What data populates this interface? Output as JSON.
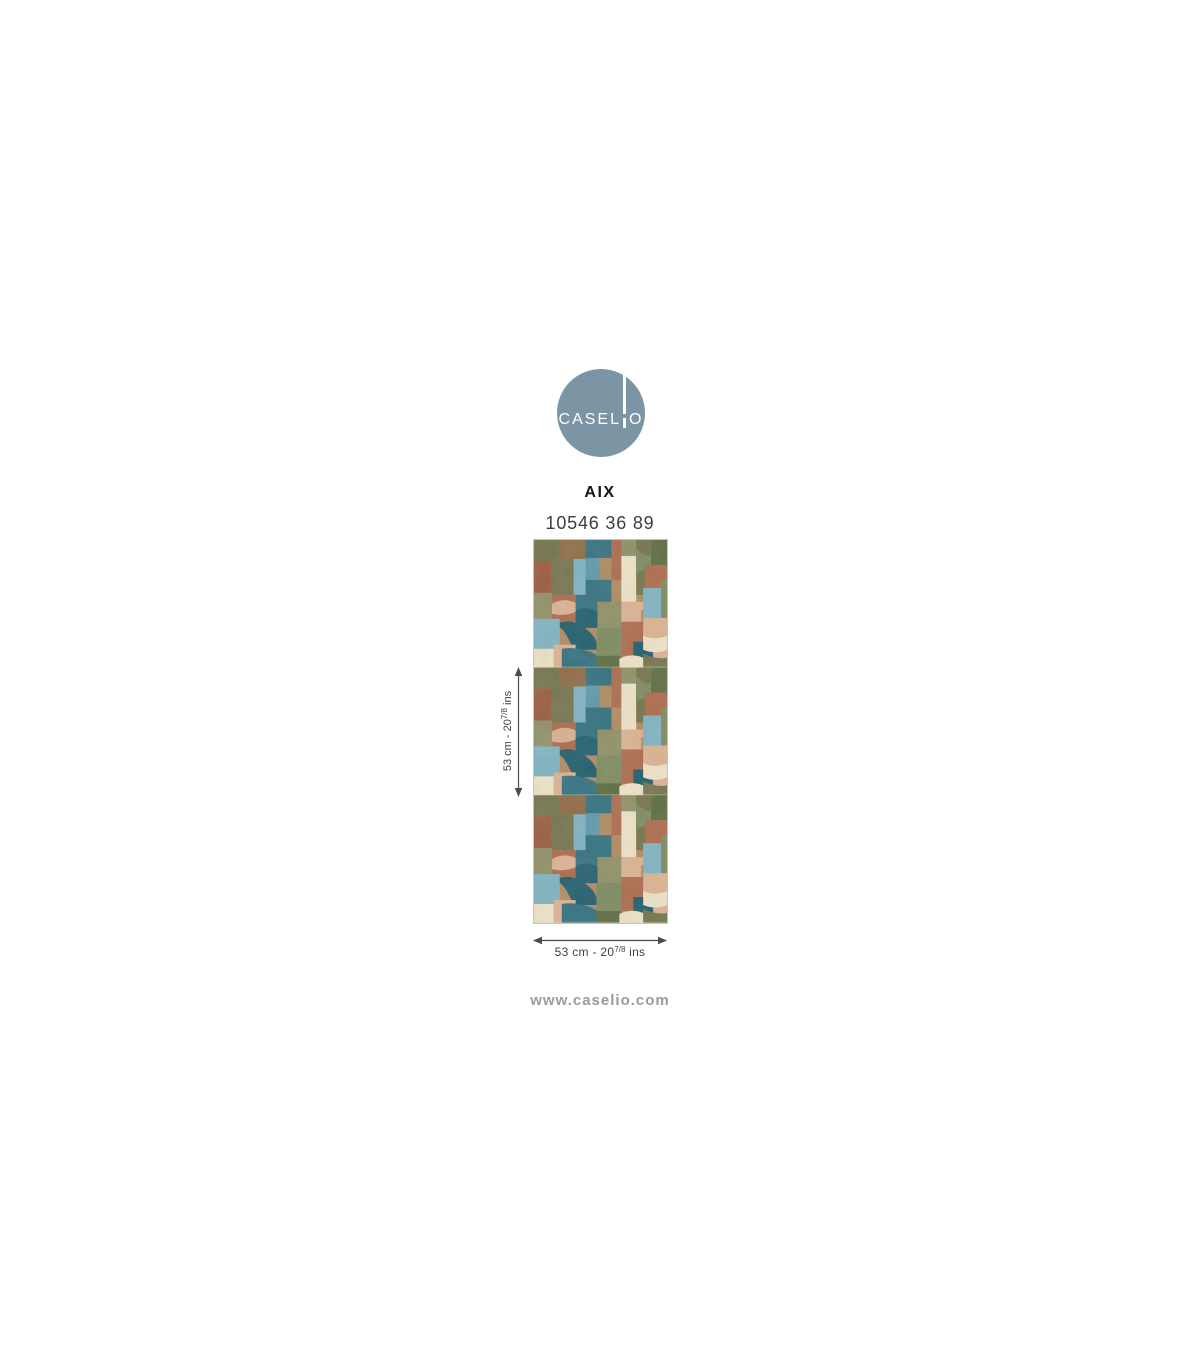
{
  "brand": {
    "name": "CASELIO",
    "wordmark_left": "CASEL",
    "wordmark_right": "O"
  },
  "product": {
    "name": "AIX",
    "reference": "10546 36 89"
  },
  "dimension_height": {
    "prefix": "53 cm - 20",
    "fraction": "7/8",
    "suffix": " ins"
  },
  "dimension_width": {
    "prefix": "53 cm - 20",
    "fraction": "7/8",
    "suffix": " ins"
  },
  "footer": {
    "website": "www.caselio.com"
  },
  "colors": {
    "brand": "#7b95a4",
    "arrow": "#4a4a4a",
    "label": "#3f3f3f",
    "website": "#9b9b9b",
    "teal": "#31707e",
    "teal-dark": "#1f5d6b",
    "blue": "#7fb3c2",
    "blue-med": "#5d98ab",
    "sage": "#8f9065",
    "green": "#7d8a5e",
    "olive": "#73744a",
    "olive-dark": "#5c6b40",
    "rust": "#ad6a4b",
    "rust-dark": "#9a5a3e",
    "brown": "#8f6a42",
    "tan": "#b08a5e",
    "peach": "#ddb291",
    "cream": "#eee3c8"
  }
}
